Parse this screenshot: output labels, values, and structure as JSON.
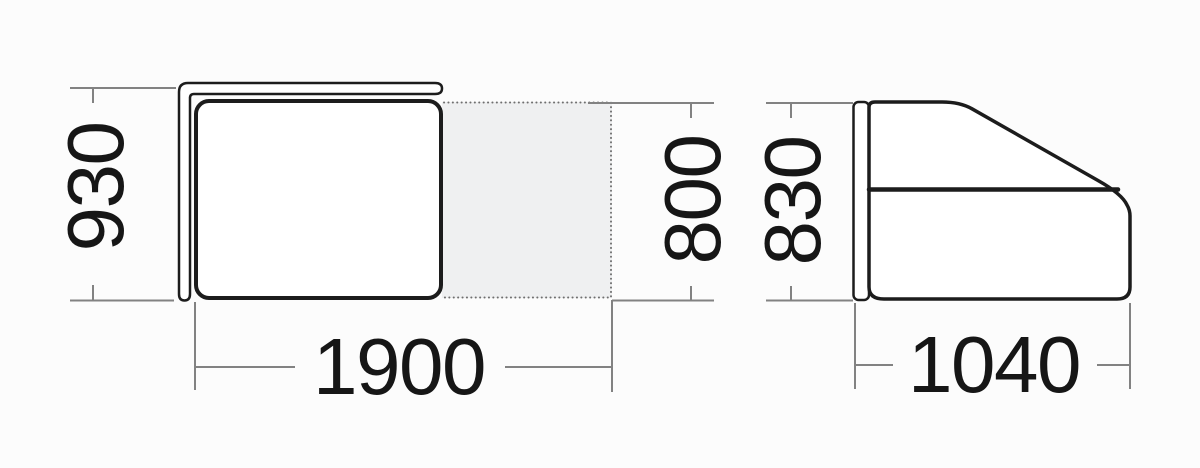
{
  "drawing_type": "furniture dimension diagram",
  "colors": {
    "background": "#fcfcfc",
    "outline": "#1c1c1c",
    "dimension_lines": "#828282",
    "dimension_text": "#161616",
    "extension_area_fill": "#eff0f1"
  },
  "plan_view": {
    "depth_label": "930",
    "width_label": "1900",
    "extension_depth_label": "800"
  },
  "side_view": {
    "height_label": "830",
    "depth_label": "1040"
  }
}
